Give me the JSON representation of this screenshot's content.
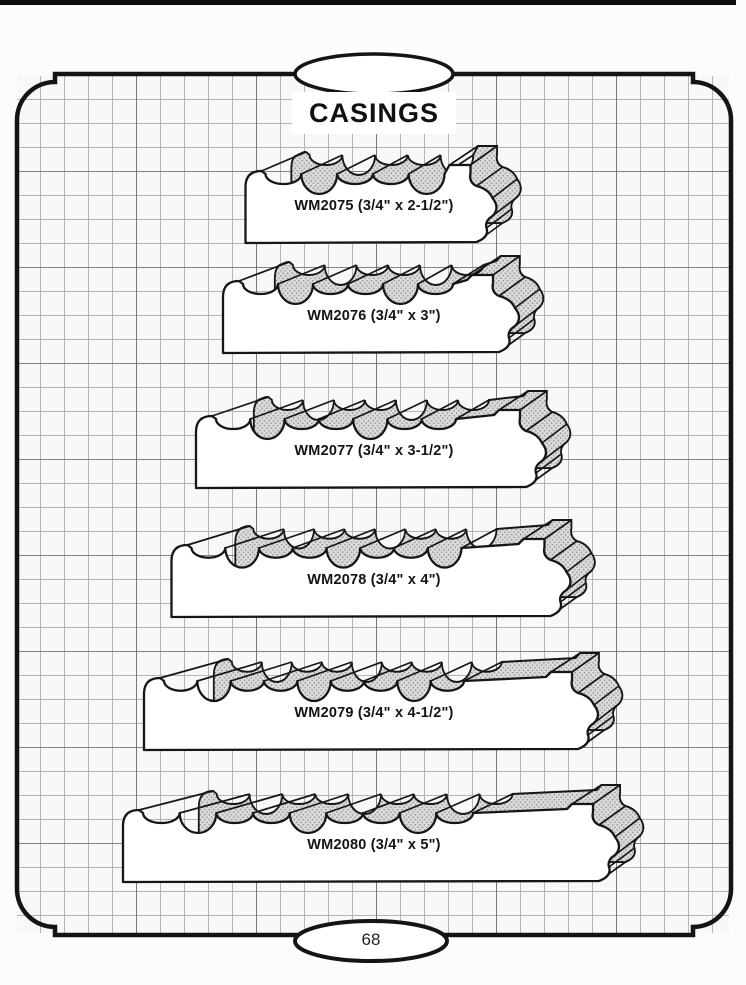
{
  "page": {
    "title": "CASINGS",
    "page_number": "68"
  },
  "casings": [
    {
      "profile": "WM2075",
      "size": "3/4\" x 2-1/2\"",
      "label": "WM2075 (3/4\" x 2-1/2\")",
      "layout": {
        "w": 257,
        "bottom": 243
      }
    },
    {
      "profile": "WM2076",
      "size": "3/4\" x 3\"",
      "label": "WM2076 (3/4\" x 3\")",
      "layout": {
        "w": 302,
        "bottom": 353
      }
    },
    {
      "profile": "WM2077",
      "size": "3/4\" x 3-1/2\"",
      "label": "WM2077 (3/4\" x 3-1/2\")",
      "layout": {
        "w": 356,
        "bottom": 488
      }
    },
    {
      "profile": "WM2078",
      "size": "3/4\" x 4\"",
      "label": "WM2078 (3/4\" x 4\")",
      "layout": {
        "w": 405,
        "bottom": 617
      }
    },
    {
      "profile": "WM2079",
      "size": "3/4\" x 4-1/2\"",
      "label": "WM2079 (3/4\" x 4-1/2\")",
      "layout": {
        "w": 460,
        "bottom": 750
      }
    },
    {
      "profile": "WM2080",
      "size": "3/4\" x 5\"",
      "label": "WM2080 (3/4\" x 5\")",
      "layout": {
        "w": 502,
        "bottom": 882
      }
    }
  ],
  "colors": {
    "outline": "#161616",
    "face_fill": "#ffffff",
    "band_fill": "#dadad8",
    "band_dot": "#8f8f8f",
    "border": "#141414"
  },
  "layout": {
    "center_x": 374,
    "depth_dy": 19
  }
}
